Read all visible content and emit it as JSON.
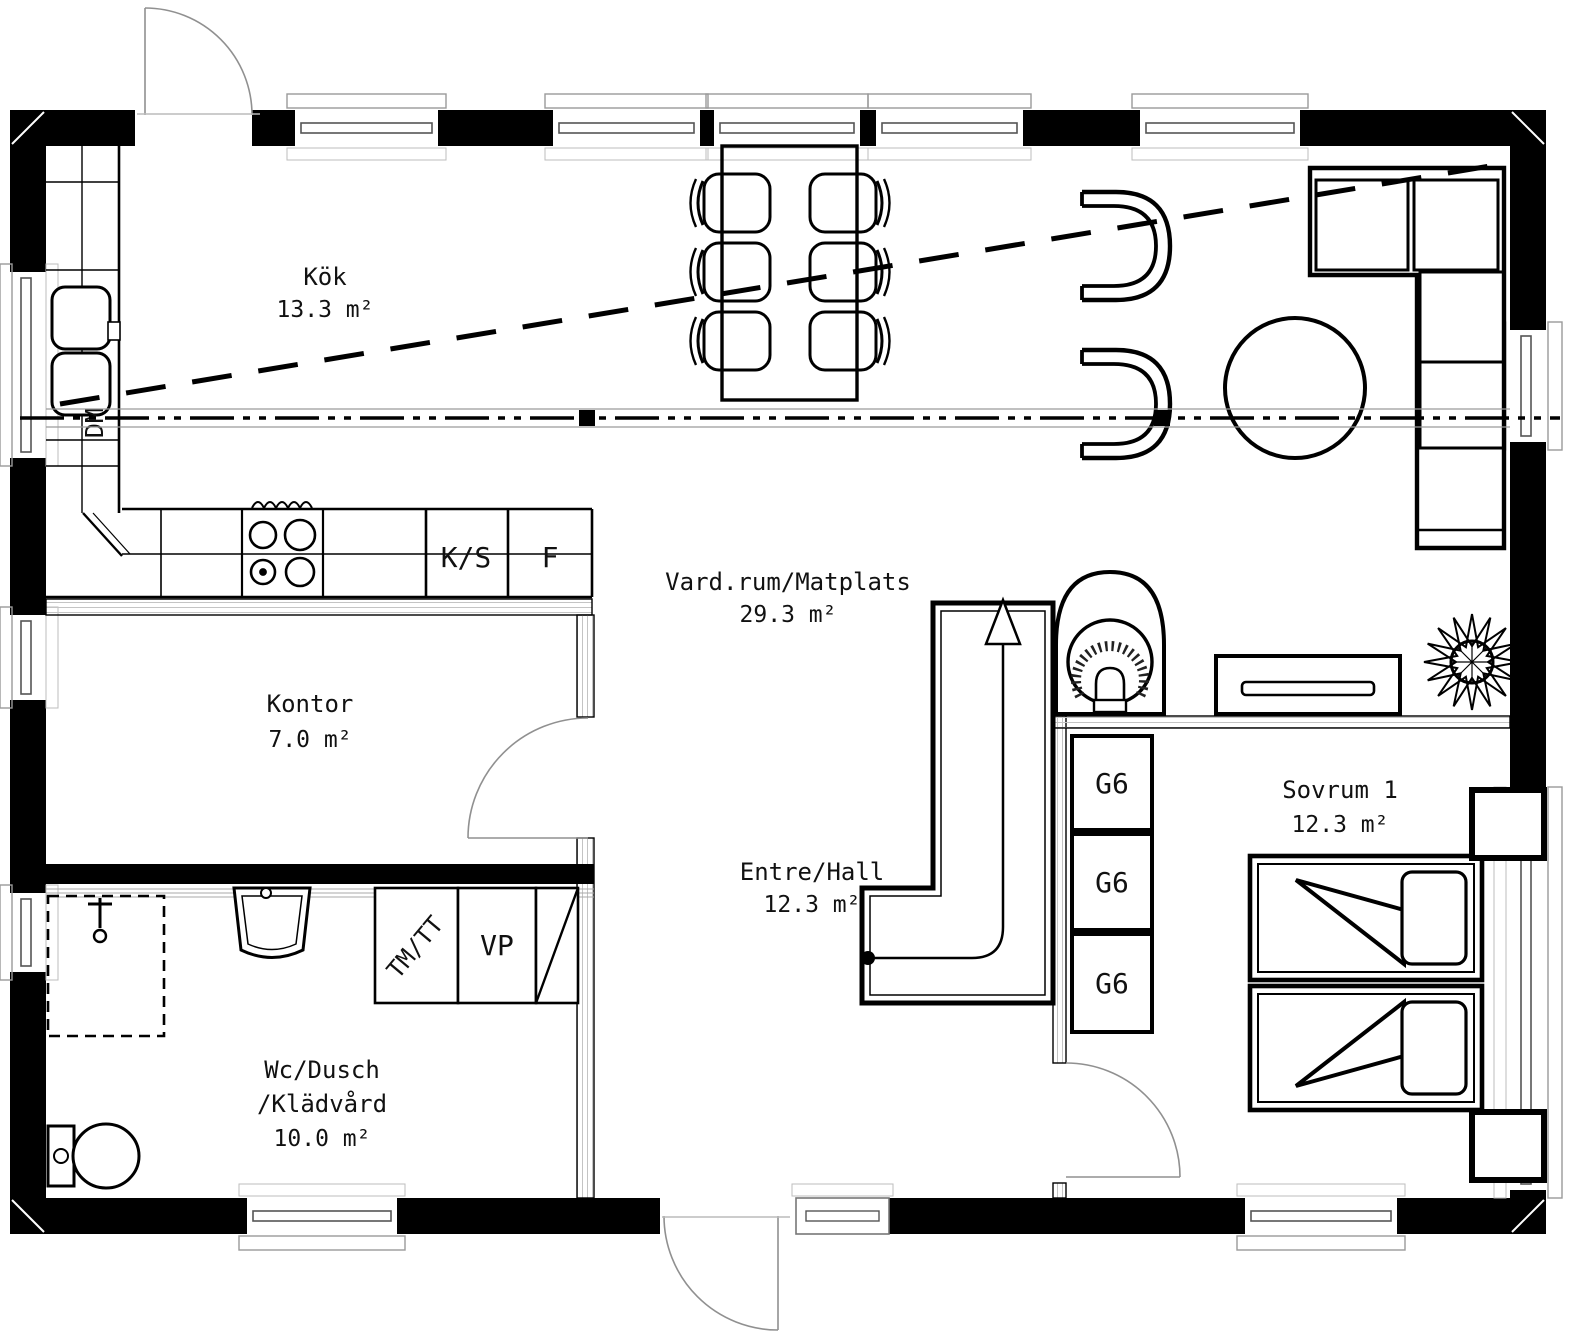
{
  "plan_title": "Floor plan",
  "rooms": [
    {
      "key": "kok",
      "name": "Kök",
      "area": "13.3 m²"
    },
    {
      "key": "vardagsrum",
      "name": "Vard.rum/Matplats",
      "area": "29.3 m²"
    },
    {
      "key": "kontor",
      "name": "Kontor",
      "area": "7.0 m²"
    },
    {
      "key": "wc",
      "name": "Wc/Dusch",
      "name2": "/Klädvård",
      "area": "10.0 m²"
    },
    {
      "key": "entre",
      "name": "Entre/Hall",
      "area": "12.3 m²"
    },
    {
      "key": "sovrum",
      "name": "Sovrum 1",
      "area": "12.3 m²"
    }
  ],
  "fixtures": {
    "dishwasher": "DM",
    "fridge_freezer": "K/S",
    "freezer": "F",
    "washer_dryer": "TM/TT",
    "water_heater": "VP",
    "wardrobe": "G6"
  },
  "colors": {
    "wall": "#000000",
    "background": "#ffffff",
    "thin_line": "#8c8c8c"
  }
}
